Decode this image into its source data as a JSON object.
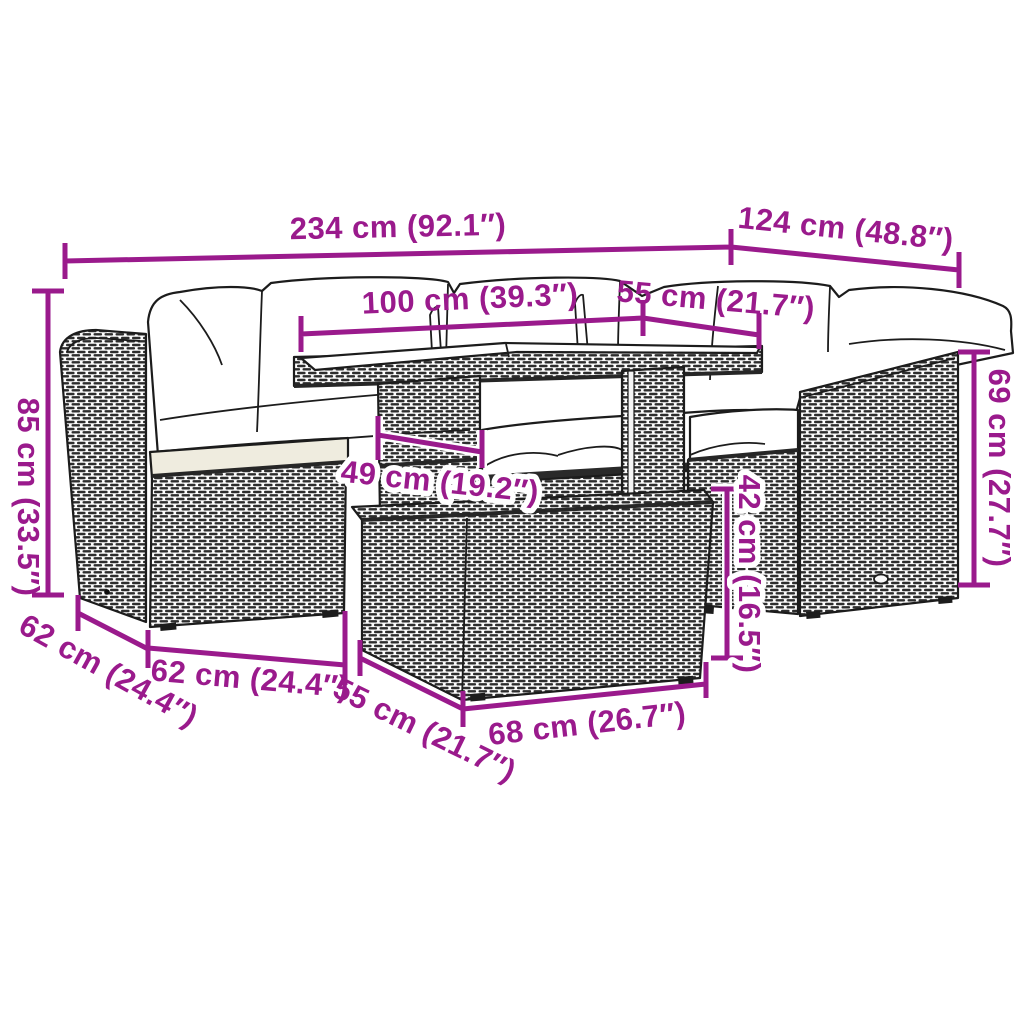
{
  "diagram": {
    "description": "Garden lounge furniture set with cushions, table and ottoman — product dimension diagram",
    "background": "#ffffff",
    "colors": {
      "dimension_lines": "#9a1a8c",
      "line_art": "#1c1c1c",
      "pillow_fill": "#ffffff",
      "seat_cushion_fill": "#efecdf",
      "wicker_dash": "#2d2d2d"
    },
    "dimensions": {
      "total_width": "234 cm (92.1″)",
      "total_depth": "124 cm (48.8″)",
      "table_length": "100 cm (39.3″)",
      "table_depth": "55 cm (21.7″)",
      "back_height": "85 cm (33.5″)",
      "arm_height": "69 cm (27.7″)",
      "table_height": "49 cm (19.2″)",
      "seat_height": "42 cm (16.5″)",
      "sofa_depth": "62 cm (24.4″)",
      "seat_width": "62 cm (24.4″)",
      "ottoman_depth": "55 cm (21.7″)",
      "ottoman_width": "68 cm (26.7″)"
    }
  }
}
